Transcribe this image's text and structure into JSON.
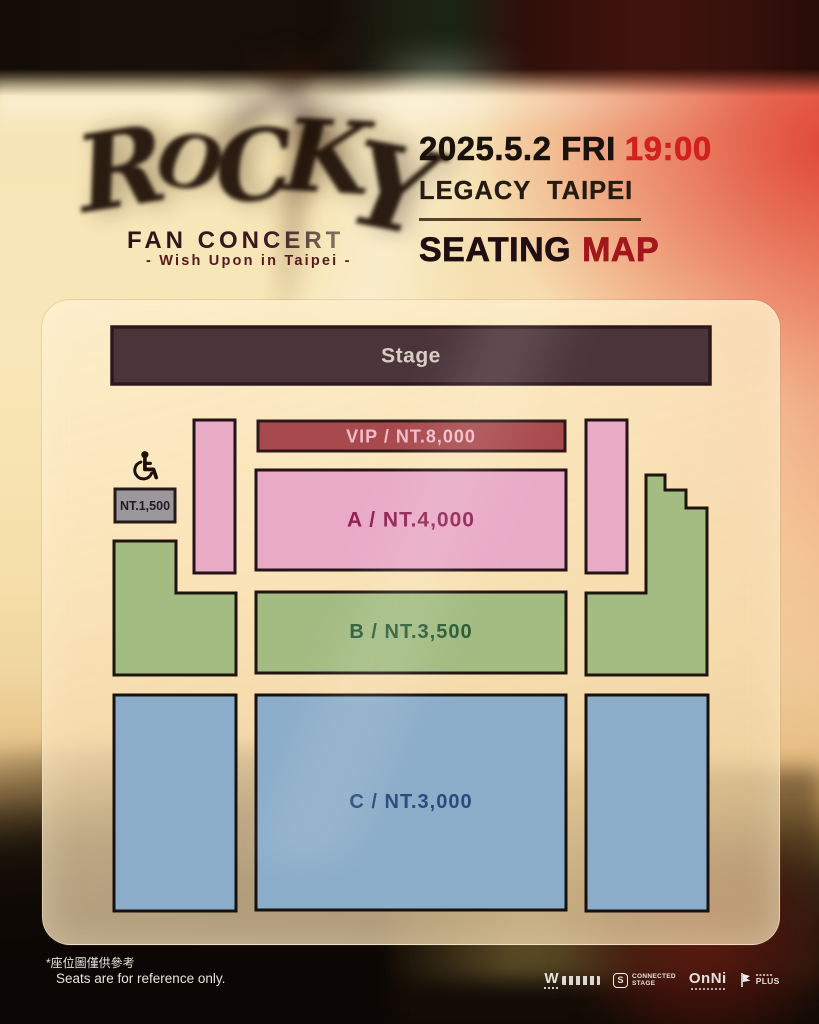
{
  "header": {
    "logo_text": "ROCKY",
    "logo_letters": [
      "R",
      "O",
      "C",
      "K",
      "Y"
    ],
    "fan_concert": "FAN CONCERT",
    "tagline": "- Wish Upon in Taipei -",
    "date": "2025.5.2 FRI",
    "time": "19:00",
    "venue": "LEGACY  TAIPEI",
    "seating_word": "SEATING",
    "map_word": "MAP"
  },
  "seating_map": {
    "stage_label": "Stage",
    "stage_color": "#4B353B",
    "outline_color": "#241418",
    "sections": [
      {
        "id": "vip",
        "name": "VIP",
        "price": "NT.8,000",
        "label": "VIP / NT.8,000",
        "color": "#A8494D"
      },
      {
        "id": "a",
        "name": "A",
        "price": "NT.4,000",
        "label": "A / NT.4,000",
        "color": "#E9AAC6"
      },
      {
        "id": "b",
        "name": "B",
        "price": "NT.3,500",
        "label": "B / NT.3,500",
        "color": "#A2BC82"
      },
      {
        "id": "c",
        "name": "C",
        "price": "NT.3,000",
        "label": "C / NT.3,000",
        "color": "#8BADCA"
      },
      {
        "id": "wheelchair",
        "price": "NT.1,500",
        "label": "NT.1,500",
        "color": "#9B989D"
      }
    ]
  },
  "footer": {
    "note_zh": "*座位圖僅供參考",
    "note_en": "Seats are for reference only.",
    "logos": {
      "w_mark": "W",
      "connected_badge": "S",
      "connected_line1": "CONNECTED",
      "connected_line2": "STAGE",
      "onni": "OnNi",
      "plus": "PLUS"
    }
  },
  "accent_colors": {
    "time_red": "#D2201F",
    "map_red": "#A3161C"
  }
}
